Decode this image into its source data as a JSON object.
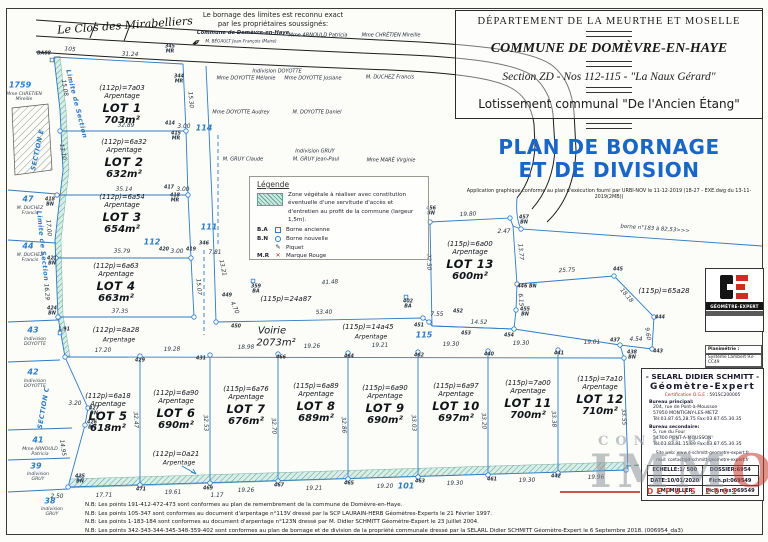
{
  "header": {
    "dept": "DÉPARTEMENT  DE  LA  MEURTHE ET MOSELLE",
    "commune": "COMMUNE DE DOMÈVRE-EN-HAYE",
    "section": "Section ZD - Nos 112-115 - \"La Naux Gérard\"",
    "lotissement": "Lotissement communal \"De l'Ancien Étang\"",
    "title1": "PLAN DE BORNAGE",
    "title2": "ET DE DIVISION",
    "app_note": "Application graphique conforme au plan d'exécution fourni par URBI-NOV le 11-12-2019 (18-27 - EXE.dwg du 13-11-2019(2MB))"
  },
  "attestation": {
    "line1": "Le bornage des limites est reconnu exact",
    "line2": "par les propriétaires soussignés:"
  },
  "legend": {
    "title": "Légende",
    "zone_text": "Zone végétale à réaliser avec constitution éventuelle d'une servitude d'accès et d'entretien au profit de la commune (largeur 1,5m).",
    "piquet_glyph": "✎",
    "mr_glyph": "✕",
    "items": [
      {
        "abbr": "B.A",
        "label": "Borne ancienne"
      },
      {
        "abbr": "B.N",
        "label": "Borne nouvelle"
      },
      {
        "abbr": "",
        "label": "Piquet"
      },
      {
        "abbr": "M.R",
        "label": "Marque Rouge"
      }
    ]
  },
  "strings": {
    "arpentage": "Arpentage"
  },
  "lots": [
    {
      "name": "LOT 1",
      "alloc": "(112p)=7a03",
      "area": "703m²",
      "x": 122,
      "y": 84
    },
    {
      "name": "LOT 2",
      "alloc": "(112p)=6a32",
      "area": "632m²",
      "x": 124,
      "y": 138
    },
    {
      "name": "LOT 3",
      "alloc": "(112p)=6a54",
      "area": "654m²",
      "x": 122,
      "y": 193
    },
    {
      "name": "LOT 4",
      "alloc": "(112p)=6a63",
      "area": "663m²",
      "x": 116,
      "y": 262
    },
    {
      "name": "LOT 5",
      "alloc": "(112p)=6a18",
      "area": "618m²",
      "x": 108,
      "y": 392
    },
    {
      "name": "LOT 6",
      "alloc": "(112p)=6a90",
      "area": "690m²",
      "x": 176,
      "y": 389
    },
    {
      "name": "LOT 7",
      "alloc": "(115p)=6a76",
      "area": "676m²",
      "x": 246,
      "y": 385
    },
    {
      "name": "LOT 8",
      "alloc": "(115p)=6a89",
      "area": "689m²",
      "x": 316,
      "y": 382
    },
    {
      "name": "LOT 9",
      "alloc": "(115p)=6a90",
      "area": "690m²",
      "x": 385,
      "y": 384
    },
    {
      "name": "LOT 10",
      "alloc": "(115p)=6a97",
      "area": "697m²",
      "x": 456,
      "y": 382
    },
    {
      "name": "LOT 11",
      "alloc": "(115p)=7a00",
      "area": "700m²",
      "x": 528,
      "y": 379
    },
    {
      "name": "LOT 12",
      "alloc": "(115p)=7a10",
      "area": "710m²",
      "x": 600,
      "y": 375
    },
    {
      "name": "LOT 13",
      "alloc": "(115p)=6a00",
      "area": "600m²",
      "x": 470,
      "y": 240
    }
  ],
  "labels": [
    {
      "t": "Le Clos des Mirabelliers",
      "x": 125,
      "y": 26,
      "c": "street",
      "r": -4,
      "n": "street-name"
    },
    {
      "t": "105",
      "x": 70,
      "y": 50,
      "c": "m",
      "r": 6
    },
    {
      "t": "31.24",
      "x": 130,
      "y": 55,
      "c": "m",
      "r": 2
    },
    {
      "t": "BA88",
      "x": 44,
      "y": 54,
      "c": "p"
    },
    {
      "t": "345\nMR",
      "x": 170,
      "y": 50,
      "c": "p"
    },
    {
      "t": "344\nMR",
      "x": 179,
      "y": 80,
      "c": "p"
    },
    {
      "t": "15.30",
      "x": 190,
      "y": 100,
      "c": "m",
      "r": 85
    },
    {
      "t": "15.08",
      "x": 64,
      "y": 88,
      "c": "m",
      "r": 80
    },
    {
      "t": "32.89",
      "x": 126,
      "y": 126,
      "c": "m",
      "r": 1
    },
    {
      "t": "414",
      "x": 170,
      "y": 124,
      "c": "p"
    },
    {
      "t": "3.00",
      "x": 184,
      "y": 127,
      "c": "m"
    },
    {
      "t": "415\nMR",
      "x": 176,
      "y": 137,
      "c": "p"
    },
    {
      "t": "13.10",
      "x": 62,
      "y": 152,
      "c": "m",
      "r": 80
    },
    {
      "t": "35.14",
      "x": 124,
      "y": 190,
      "c": "m",
      "r": 1
    },
    {
      "t": "417",
      "x": 169,
      "y": 188,
      "c": "p"
    },
    {
      "t": "3.00",
      "x": 183,
      "y": 190,
      "c": "m"
    },
    {
      "t": "418\nMR",
      "x": 175,
      "y": 199,
      "c": "p"
    },
    {
      "t": "418\nBN",
      "x": 50,
      "y": 203,
      "c": "p"
    },
    {
      "t": "17.00",
      "x": 48,
      "y": 228,
      "c": "m",
      "r": 85
    },
    {
      "t": "421\nBN",
      "x": 52,
      "y": 262,
      "c": "p"
    },
    {
      "t": "16.29",
      "x": 46,
      "y": 292,
      "c": "m",
      "r": 85
    },
    {
      "t": "424\nBN",
      "x": 52,
      "y": 312,
      "c": "p"
    },
    {
      "t": "1.91",
      "x": 64,
      "y": 330,
      "c": "p"
    },
    {
      "t": "35.79",
      "x": 122,
      "y": 252,
      "c": "m",
      "r": 1
    },
    {
      "t": "420",
      "x": 164,
      "y": 250,
      "c": "p"
    },
    {
      "t": "3.00",
      "x": 177,
      "y": 252,
      "c": "m"
    },
    {
      "t": "419",
      "x": 191,
      "y": 250,
      "c": "p"
    },
    {
      "t": "346",
      "x": 204,
      "y": 244,
      "c": "p"
    },
    {
      "t": "7.81",
      "x": 215,
      "y": 253,
      "c": "m"
    },
    {
      "t": "15.07",
      "x": 198,
      "y": 287,
      "c": "m",
      "r": 85
    },
    {
      "t": "13.21",
      "x": 222,
      "y": 268,
      "c": "m",
      "r": 78
    },
    {
      "t": "37.35",
      "x": 120,
      "y": 312,
      "c": "m",
      "r": 1
    },
    {
      "t": "Limite de Section",
      "x": 76,
      "y": 104,
      "c": "sec",
      "r": 76
    },
    {
      "t": "Limite de Section",
      "x": 42,
      "y": 246,
      "c": "sec",
      "r": 84
    },
    {
      "t": "SECTION E",
      "x": 38,
      "y": 150,
      "c": "sec",
      "r": -78
    },
    {
      "t": "SECTION C",
      "x": 44,
      "y": 408,
      "c": "sec",
      "r": -80
    },
    {
      "t": "1759",
      "x": 20,
      "y": 86,
      "c": "pnum"
    },
    {
      "t": "Mme CHRETIEN\nMireille",
      "x": 24,
      "y": 97,
      "c": "pname"
    },
    {
      "t": "47",
      "x": 28,
      "y": 200,
      "c": "pnum"
    },
    {
      "t": "M. DUCHEZ\nFrancis",
      "x": 30,
      "y": 211,
      "c": "pname"
    },
    {
      "t": "44",
      "x": 28,
      "y": 247,
      "c": "pnum"
    },
    {
      "t": "M. DUCHEZ\nFrancis",
      "x": 30,
      "y": 258,
      "c": "pname"
    },
    {
      "t": "43",
      "x": 33,
      "y": 331,
      "c": "pnum"
    },
    {
      "t": "Indivision\nDOYOTTE",
      "x": 35,
      "y": 342,
      "c": "pname"
    },
    {
      "t": "42",
      "x": 33,
      "y": 373,
      "c": "pnum"
    },
    {
      "t": "Indivision\nDOYOTTE",
      "x": 35,
      "y": 384,
      "c": "pname"
    },
    {
      "t": "41",
      "x": 38,
      "y": 441,
      "c": "pnum"
    },
    {
      "t": "Mme ARNOULD\nPatricia",
      "x": 40,
      "y": 452,
      "c": "pname"
    },
    {
      "t": "39",
      "x": 36,
      "y": 467,
      "c": "pnum"
    },
    {
      "t": "Indivision\nGRUY",
      "x": 38,
      "y": 477,
      "c": "pname"
    },
    {
      "t": "38",
      "x": 50,
      "y": 502,
      "c": "pnum"
    },
    {
      "t": "Indivision\nGRUY",
      "x": 52,
      "y": 512,
      "c": "pname"
    },
    {
      "t": "114",
      "x": 204,
      "y": 129,
      "c": "pnum"
    },
    {
      "t": "112",
      "x": 152,
      "y": 243,
      "c": "pnum"
    },
    {
      "t": "111",
      "x": 209,
      "y": 228,
      "c": "pnum"
    },
    {
      "t": "115",
      "x": 424,
      "y": 336,
      "c": "pnum"
    },
    {
      "t": "101",
      "x": 406,
      "y": 487,
      "c": "pnum"
    },
    {
      "t": "Commune de Domèvre-en-Haye",
      "x": 243,
      "y": 34,
      "c": "sigb"
    },
    {
      "t": "M. BÉGAULT Jean-François (Maire)",
      "x": 241,
      "y": 42,
      "c": "sig4"
    },
    {
      "t": "Mme ARNOULD Patricia",
      "x": 318,
      "y": 36,
      "c": "sig"
    },
    {
      "t": "Mme CHRÉTIEN Mireille",
      "x": 391,
      "y": 36,
      "c": "sig"
    },
    {
      "t": "Indivision DOYOTTE",
      "x": 277,
      "y": 72,
      "c": "sig"
    },
    {
      "t": "Mme DOYOTTE Mélanie",
      "x": 246,
      "y": 79,
      "c": "sig"
    },
    {
      "t": "Mme DOYOTTE Josiane",
      "x": 313,
      "y": 79,
      "c": "sig"
    },
    {
      "t": "M. DUCHEZ Francis",
      "x": 390,
      "y": 78,
      "c": "sig"
    },
    {
      "t": "Mme DOYOTTE Audrey",
      "x": 241,
      "y": 113,
      "c": "sig"
    },
    {
      "t": "M. DOYOTTE Daniel",
      "x": 317,
      "y": 113,
      "c": "sig"
    },
    {
      "t": "M. GRUY Claude",
      "x": 243,
      "y": 160,
      "c": "sig"
    },
    {
      "t": "Indivision GRUY",
      "x": 315,
      "y": 152,
      "c": "sig"
    },
    {
      "t": "M. GRUY Jean-Paul",
      "x": 316,
      "y": 160,
      "c": "sig"
    },
    {
      "t": "Mme MARÉ Virginie",
      "x": 391,
      "y": 161,
      "c": "sig"
    },
    {
      "t": "449",
      "x": 227,
      "y": 296,
      "c": "p"
    },
    {
      "t": "4.70",
      "x": 234,
      "y": 308,
      "c": "m",
      "r": 65
    },
    {
      "t": "450",
      "x": 236,
      "y": 327,
      "c": "p"
    },
    {
      "t": "359\nBA",
      "x": 256,
      "y": 290,
      "c": "p"
    },
    {
      "t": "41.48",
      "x": 330,
      "y": 283,
      "c": "m",
      "r": -4
    },
    {
      "t": "402\nBA",
      "x": 408,
      "y": 305,
      "c": "p"
    },
    {
      "t": "(115p)=24a87",
      "x": 286,
      "y": 300,
      "c": "area"
    },
    {
      "t": "53.40",
      "x": 324,
      "y": 313,
      "c": "m",
      "r": -1
    },
    {
      "t": "451",
      "x": 419,
      "y": 326,
      "c": "p"
    },
    {
      "t": "7.55",
      "x": 437,
      "y": 315,
      "c": "m"
    },
    {
      "t": "452",
      "x": 458,
      "y": 312,
      "c": "p"
    },
    {
      "t": "Voirie",
      "x": 272,
      "y": 331,
      "c": "areaXL"
    },
    {
      "t": "2073m²",
      "x": 276,
      "y": 343,
      "c": "areaXL"
    },
    {
      "t": "(115p)=14a45",
      "x": 368,
      "y": 328,
      "c": "area"
    },
    {
      "t": "Arpentage",
      "x": 371,
      "y": 338,
      "c": "arp2"
    },
    {
      "t": "(112p)=8a28",
      "x": 116,
      "y": 331,
      "c": "area"
    },
    {
      "t": "Arpentage",
      "x": 119,
      "y": 341,
      "c": "arp2"
    },
    {
      "t": "(112p)=0a21",
      "x": 176,
      "y": 455,
      "c": "area"
    },
    {
      "t": "Arpentage",
      "x": 179,
      "y": 464,
      "c": "arp2"
    },
    {
      "t": "17.20",
      "x": 103,
      "y": 351,
      "c": "m",
      "r": -1
    },
    {
      "t": "429",
      "x": 140,
      "y": 361,
      "c": "p"
    },
    {
      "t": "19.28",
      "x": 172,
      "y": 350,
      "c": "m",
      "r": -1
    },
    {
      "t": "431",
      "x": 201,
      "y": 359,
      "c": "p"
    },
    {
      "t": "18.98",
      "x": 246,
      "y": 348,
      "c": "m",
      "r": -1
    },
    {
      "t": "466",
      "x": 281,
      "y": 358,
      "c": "p"
    },
    {
      "t": "19.26",
      "x": 312,
      "y": 347,
      "c": "m",
      "r": -1
    },
    {
      "t": "464",
      "x": 349,
      "y": 357,
      "c": "p"
    },
    {
      "t": "19.21",
      "x": 380,
      "y": 346,
      "c": "m",
      "r": -1
    },
    {
      "t": "462",
      "x": 419,
      "y": 356,
      "c": "p"
    },
    {
      "t": "19.30",
      "x": 451,
      "y": 345,
      "c": "m",
      "r": -1
    },
    {
      "t": "440",
      "x": 489,
      "y": 355,
      "c": "p"
    },
    {
      "t": "19.30",
      "x": 521,
      "y": 344,
      "c": "m",
      "r": -1
    },
    {
      "t": "441",
      "x": 559,
      "y": 354,
      "c": "p"
    },
    {
      "t": "19.01",
      "x": 592,
      "y": 343,
      "c": "m",
      "r": -1
    },
    {
      "t": "438\nBN",
      "x": 632,
      "y": 356,
      "c": "p"
    },
    {
      "t": "32.47",
      "x": 135,
      "y": 420,
      "c": "m",
      "r": 87
    },
    {
      "t": "32.53",
      "x": 205,
      "y": 423,
      "c": "m",
      "r": 87
    },
    {
      "t": "32.70",
      "x": 273,
      "y": 426,
      "c": "m",
      "r": 87
    },
    {
      "t": "32.86",
      "x": 343,
      "y": 425,
      "c": "m",
      "r": 87
    },
    {
      "t": "33.03",
      "x": 413,
      "y": 423,
      "c": "m",
      "r": 87
    },
    {
      "t": "33.20",
      "x": 483,
      "y": 421,
      "c": "m",
      "r": 87
    },
    {
      "t": "33.38",
      "x": 553,
      "y": 419,
      "c": "m",
      "r": 87
    },
    {
      "t": "33.55",
      "x": 623,
      "y": 417,
      "c": "m",
      "r": 87
    },
    {
      "t": "3.20",
      "x": 75,
      "y": 404,
      "c": "m"
    },
    {
      "t": "427\nBN",
      "x": 94,
      "y": 412,
      "c": "p"
    },
    {
      "t": "426\nBN",
      "x": 92,
      "y": 426,
      "c": "p"
    },
    {
      "t": "14.95",
      "x": 62,
      "y": 448,
      "c": "m",
      "r": 82
    },
    {
      "t": "2.50",
      "x": 57,
      "y": 497,
      "c": "m"
    },
    {
      "t": "425\nBN",
      "x": 80,
      "y": 480,
      "c": "p"
    },
    {
      "t": "17.71",
      "x": 104,
      "y": 496,
      "c": "m",
      "r": -1
    },
    {
      "t": "471",
      "x": 141,
      "y": 490,
      "c": "p"
    },
    {
      "t": "19.61",
      "x": 173,
      "y": 493,
      "c": "m",
      "r": -1
    },
    {
      "t": "469",
      "x": 208,
      "y": 489,
      "c": "p"
    },
    {
      "t": "1.17",
      "x": 217,
      "y": 496,
      "c": "m"
    },
    {
      "t": "19.26",
      "x": 246,
      "y": 491,
      "c": "m",
      "r": -1
    },
    {
      "t": "467",
      "x": 279,
      "y": 486,
      "c": "p"
    },
    {
      "t": "19.21",
      "x": 314,
      "y": 489,
      "c": "m",
      "r": -1
    },
    {
      "t": "465",
      "x": 349,
      "y": 484,
      "c": "p"
    },
    {
      "t": "19.20",
      "x": 385,
      "y": 487,
      "c": "m",
      "r": -1
    },
    {
      "t": "463",
      "x": 420,
      "y": 482,
      "c": "p"
    },
    {
      "t": "19.30",
      "x": 455,
      "y": 484,
      "c": "m",
      "r": -1
    },
    {
      "t": "461",
      "x": 492,
      "y": 480,
      "c": "p"
    },
    {
      "t": "19.30",
      "x": 527,
      "y": 481,
      "c": "m",
      "r": -1
    },
    {
      "t": "442",
      "x": 556,
      "y": 477,
      "c": "p"
    },
    {
      "t": "19.96",
      "x": 596,
      "y": 478,
      "c": "m",
      "r": -1
    },
    {
      "t": "19.80",
      "x": 468,
      "y": 215,
      "c": "m",
      "r": -2
    },
    {
      "t": "456\nBN",
      "x": 431,
      "y": 212,
      "c": "p"
    },
    {
      "t": "2.47",
      "x": 504,
      "y": 232,
      "c": "m"
    },
    {
      "t": "457\nBN",
      "x": 524,
      "y": 221,
      "c": "p"
    },
    {
      "t": "13.77",
      "x": 520,
      "y": 252,
      "c": "m",
      "r": 85
    },
    {
      "t": "22.50",
      "x": 428,
      "y": 262,
      "c": "m",
      "r": 88
    },
    {
      "t": "446 BN",
      "x": 527,
      "y": 287,
      "c": "p"
    },
    {
      "t": "25.75",
      "x": 567,
      "y": 271,
      "c": "m",
      "r": -3
    },
    {
      "t": "6.15",
      "x": 520,
      "y": 300,
      "c": "m",
      "r": 85
    },
    {
      "t": "455\nBN",
      "x": 525,
      "y": 313,
      "c": "p"
    },
    {
      "t": "14.52",
      "x": 479,
      "y": 323,
      "c": "m",
      "r": 1
    },
    {
      "t": "453",
      "x": 466,
      "y": 334,
      "c": "p"
    },
    {
      "t": "454",
      "x": 509,
      "y": 336,
      "c": "p"
    },
    {
      "t": "445",
      "x": 618,
      "y": 270,
      "c": "p"
    },
    {
      "t": "18.18",
      "x": 626,
      "y": 296,
      "c": "m",
      "r": 50
    },
    {
      "t": "444",
      "x": 660,
      "y": 318,
      "c": "p"
    },
    {
      "t": "9.60",
      "x": 647,
      "y": 334,
      "c": "m",
      "r": 80
    },
    {
      "t": "437",
      "x": 615,
      "y": 341,
      "c": "p"
    },
    {
      "t": "4.54",
      "x": 636,
      "y": 340,
      "c": "m"
    },
    {
      "t": "443",
      "x": 658,
      "y": 352,
      "c": "p"
    },
    {
      "t": "(115p)=65a28",
      "x": 664,
      "y": 292,
      "c": "area"
    },
    {
      "t": "borne n°183 à 82,53>>>",
      "x": 655,
      "y": 230,
      "c": "borne",
      "r": 4
    },
    {
      "t": "borne n°184 à 115.09 >>>",
      "x": 700,
      "y": 479,
      "c": "borne",
      "r": -2
    },
    {
      "t": "✒",
      "x": 197,
      "y": 43,
      "c": "sym",
      "r": -35,
      "n": "pen-icon"
    }
  ],
  "logo_box": {
    "brand": "GÉOMÈTRE-EXPERT"
  },
  "geo_refs": {
    "plan_label": "Planimétrie :",
    "plan_value": "Système Lambert 93-CC49",
    "alt_label": "Altimétrie :",
    "alt_value": "Altitude Normale IGN 69"
  },
  "titleblock": {
    "name": "-  SELARL DIDIER SCHMITT  -",
    "role": "Géomètre-Expert",
    "cert_label": "Certification O.G.E :",
    "cert_value": "591SC200005",
    "office1_label": "Bureau principal:",
    "office1": [
      "204, rue de Pont-à-Mousson",
      "57950 MONTIGNY-LES-METZ",
      "Tél:03.87.65.28.75  Fax:03.87.65.30.35"
    ],
    "office2_label": "Bureau secondaire:",
    "office2": [
      "5, rue du Four",
      "54700 PONT-A-MOUSSON",
      "Tél:03.83.81.15.89  Fax:03.87.65.30.35"
    ],
    "web": "Site web: www.d-schmitt-geometre-expert.fr",
    "mail": "mail: contact@d-schmitt-geometre-expert.fr",
    "table": [
      [
        "ECHELLE:1/ 500",
        "DOSSIER:6954"
      ],
      [
        "DATE:10/01/2020",
        "Fich.pl:069549"
      ],
      [
        "J.M. MULLER",
        "Fich.mes:069549"
      ]
    ]
  },
  "watermark": {
    "top": "CONCEPT",
    "big": "IMM",
    "big_accent": "O",
    "bottom": "DEPUIS 2001"
  },
  "notes": [
    "N.B: Les points 191-412-472-473 sont conformes au plan de remembrement de la commune de Domèvre-en-Haye.",
    "N.B: Les points 105-347 sont conformes au document d'arpentage  n°113V dressé par la SCP LAURAIN-HERB Géomètres-Experts le 21 Février 1997.",
    "N.B: Les points 1-183-184 sont conformes au document d'arpentage  n°123N dressé par M. Didier SCHMITT Géomètre-Expert le 23 Juillet 2004.",
    "N.B: Les points 342-343-344-345-348-359-402 sont conformes au plan de bornage et de division de la propriété communale dressé par la SELARL Didier SCHMITT Géomètre-Expert le 6 Septembre 2018. (006954_da3)"
  ],
  "colors": {
    "line_blue": "#2e7cc4",
    "title_blue": "#1766c8",
    "green": "#5aa493",
    "red": "#c0392b"
  }
}
